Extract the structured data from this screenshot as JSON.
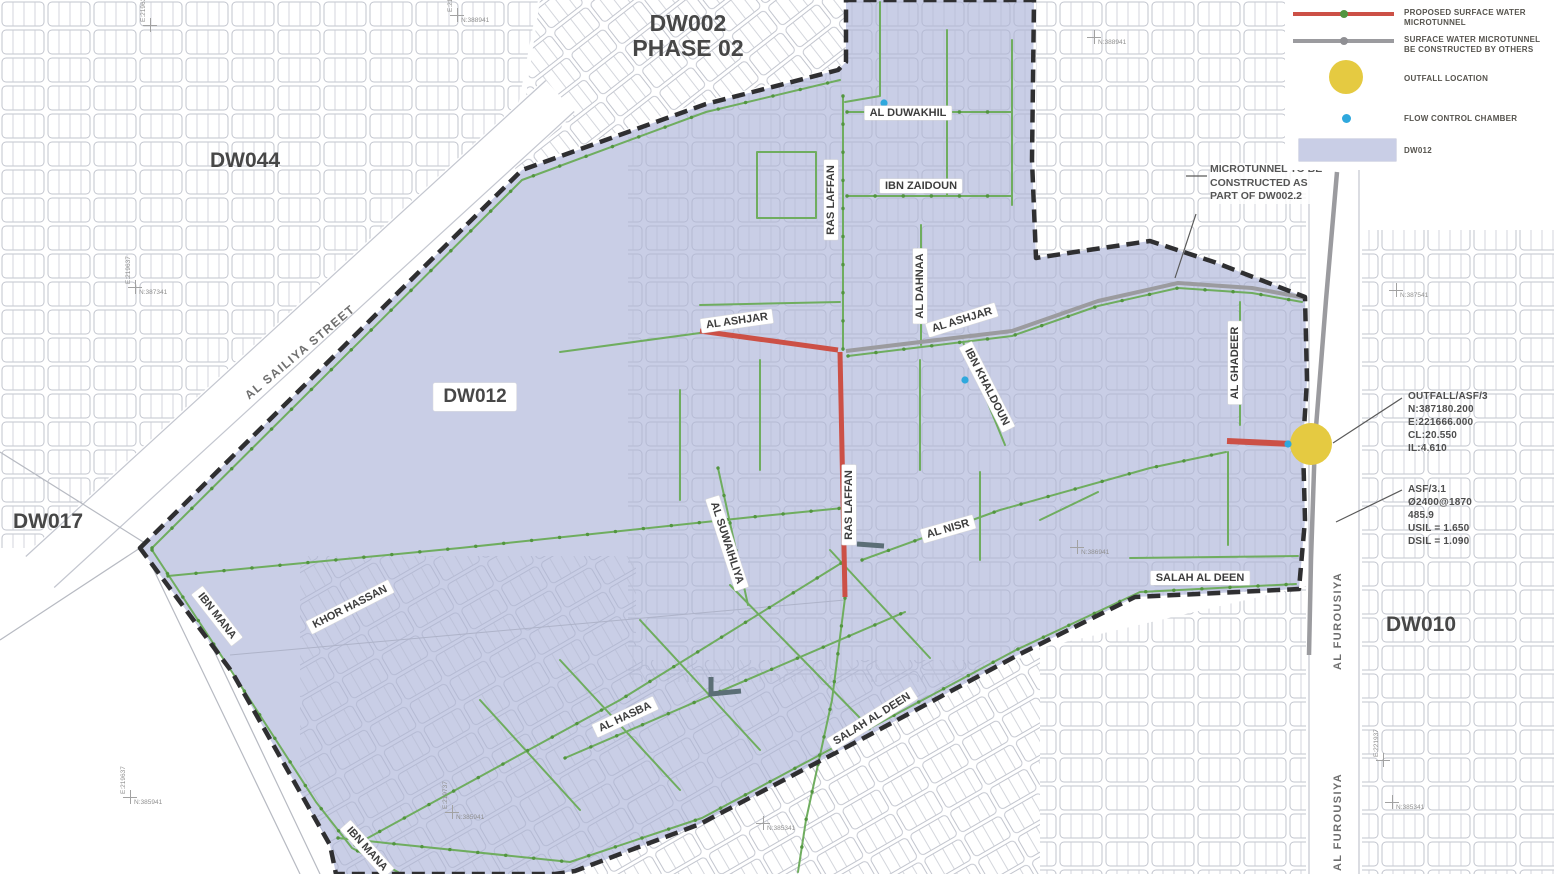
{
  "regions": {
    "dw044": "DW044",
    "dw002_line1": "DW002",
    "dw002_line2": "PHASE 02",
    "dw012": "DW012",
    "dw010": "DW010",
    "dw017": "DW017"
  },
  "streets": [
    {
      "label": "AL SAILIYA STREET"
    },
    {
      "label": "AL ASHJAR"
    },
    {
      "label": "AL ASHJAR"
    },
    {
      "label": "RAS LAFFAN"
    },
    {
      "label": "AL DUWAKHIL"
    },
    {
      "label": "IBN ZAIDOUN"
    },
    {
      "label": "AL DAHNAA"
    },
    {
      "label": "IBN KHALDOUN"
    },
    {
      "label": "AL GHADEER"
    },
    {
      "label": "RAS LAFFAN"
    },
    {
      "label": "AL SUWAIHLIYA"
    },
    {
      "label": "AL NISR"
    },
    {
      "label": "SALAH AL DEEN"
    },
    {
      "label": "KHOR HASSAN"
    },
    {
      "label": "IBN MANA"
    },
    {
      "label": "AL HASBA"
    },
    {
      "label": "SALAH AL DEEN"
    },
    {
      "label": "IBN MANA"
    },
    {
      "label": "AL FUROUSIYA"
    },
    {
      "label": "AL FUROUSIYA"
    }
  ],
  "legend": {
    "items": [
      {
        "symbol": "proposed-microtunnel-line",
        "color": "#cc5046",
        "lines": [
          "PROPOSED SURFACE WATER",
          "MICROTUNNEL"
        ]
      },
      {
        "symbol": "microtunnel-by-others-line",
        "color": "#9b9b9f",
        "lines": [
          "SURFACE WATER MICROTUNNEL",
          "BE CONSTRUCTED BY OTHERS"
        ]
      },
      {
        "symbol": "outfall-circle",
        "color": "#e5ca41",
        "lines": [
          "OUTFALL LOCATION"
        ]
      },
      {
        "symbol": "flow-control-chamber-dot",
        "color": "#2fa8dd",
        "lines": [
          "FLOW CONTROL CHAMBER"
        ]
      },
      {
        "symbol": "dw012-area-swatch",
        "color": "#c9cee6",
        "lines": [
          "DW012"
        ]
      }
    ]
  },
  "annotation": {
    "lines": [
      "MICROTUNNEL TO BE",
      "CONSTRUCTED AS",
      "PART OF DW002.2"
    ]
  },
  "callouts": {
    "outfall": {
      "lines": [
        "OUTFALL/ASF/3",
        "N:387180.200",
        "E:221666.000",
        "CL:20.550",
        "IL:4.610"
      ]
    },
    "asf": {
      "lines": [
        "ASF/3.1",
        "Ø2400@1870",
        "485.9",
        "USIL = 1.650",
        "DSIL = 1.090"
      ]
    }
  },
  "survey_marks": [
    {
      "e": "E:219637",
      "n": "N:387341"
    },
    {
      "e": "E:219837",
      "n": "N:388941"
    },
    {
      "e": "E:219637",
      "n": "N:385941"
    },
    {
      "e": "E:219737",
      "n": "N:385941"
    },
    {
      "e": "",
      "n": "N:385341"
    },
    {
      "e": "",
      "n": "N:386941"
    },
    {
      "e": "",
      "n": "N:388941"
    },
    {
      "e": "",
      "n": "N:387541"
    },
    {
      "e": "E:221937",
      "n": ""
    },
    {
      "e": "",
      "n": "N:385341"
    },
    {
      "e": "E:219637",
      "n": ""
    }
  ],
  "colors": {
    "dw012_fill": "#c9cee6",
    "proposed_microtunnel": "#cc5046",
    "microtunnel_by_others": "#9b9b9f",
    "drainage_network": "#6fad5f",
    "outfall": "#e5ca41",
    "flow_control_chamber": "#2fa8dd",
    "boundary_dash": "#2f2f31"
  }
}
